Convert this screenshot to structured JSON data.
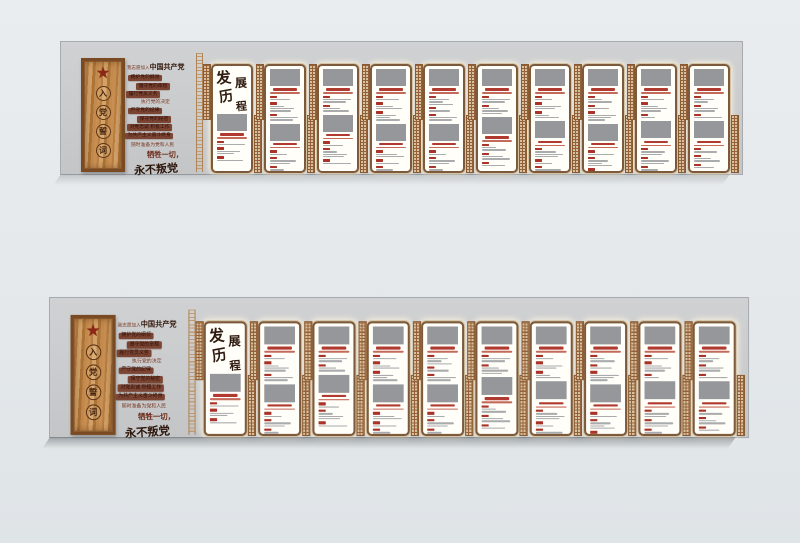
{
  "page": {
    "background": "#e6eaec",
    "banner_count": 2,
    "banner_instances": [
      "upper",
      "lower"
    ],
    "description_names": [
      "party-oath-plaque",
      "development-history-timeline-wall"
    ]
  },
  "colors": {
    "page_bg": "#e6eaec",
    "strip_gray": "#c9cbcd",
    "wood": "#c08a4e",
    "wood_frame": "#7a4a22",
    "star_red": "#8c2717",
    "oath_box": "#7c4433",
    "oath_text": "#7c3a24",
    "calligraphy_dark": "#2e1b10",
    "panel_border": "#7d5a3c",
    "accent_red": "#b13a30",
    "badge_red": "#a93328",
    "photo_gray": "#95979a",
    "lattice_tan": "#d7c2a0",
    "lattice_line": "#8a5a30"
  },
  "banner": {
    "plaque": {
      "star_icon": "red-star",
      "title_chars": [
        "入",
        "党",
        "誓",
        "词"
      ]
    },
    "oath": {
      "intro_prefix": "我志愿加入",
      "intro_party": "中国共产党",
      "lines": [
        {
          "text": "拥护党的纲领",
          "boxed": true,
          "indent": 3
        },
        {
          "text": "遵守党的章程",
          "boxed": true,
          "indent": 11
        },
        {
          "text": "履行党员义务",
          "boxed": true,
          "indent": 1
        },
        {
          "text": "执行党的决定",
          "boxed": false,
          "indent": 15
        },
        {
          "text": "严守党的纪律",
          "boxed": true,
          "indent": 3
        },
        {
          "text": "保守党的秘密",
          "boxed": true,
          "indent": 12
        },
        {
          "text": "对党忠诚  积极工作",
          "boxed": true,
          "indent": 2
        },
        {
          "text": "为共产主义奋斗终身",
          "boxed": true,
          "indent": 0
        }
      ],
      "ready": "随时准备为党和人民",
      "sacrifice": "牺牲一切，",
      "never": "永不叛党"
    },
    "intro_panel": {
      "title_chars": [
        "发",
        "展",
        "历",
        "程"
      ],
      "photo": "photo-placeholder",
      "entries": [
        1,
        2,
        1
      ]
    },
    "content_panels": [
      {
        "sections": [
          [
            1,
            3,
            2
          ],
          [
            1,
            2,
            2,
            1
          ]
        ]
      },
      {
        "sections": [
          [
            2,
            2
          ],
          [
            1,
            3,
            1
          ]
        ]
      },
      {
        "sections": [
          [
            1,
            2,
            3
          ],
          [
            2,
            1,
            2
          ]
        ]
      },
      {
        "sections": [
          [
            3,
            1,
            2
          ],
          [
            1,
            2,
            3
          ]
        ]
      },
      {
        "sections": [
          [
            2,
            3
          ],
          [
            2,
            2,
            1
          ]
        ]
      },
      {
        "sections": [
          [
            1,
            2,
            2
          ],
          [
            3,
            1,
            2
          ]
        ]
      },
      {
        "sections": [
          [
            2,
            1,
            3
          ],
          [
            1,
            3,
            2
          ]
        ]
      },
      {
        "sections": [
          [
            1,
            3,
            1
          ],
          [
            2,
            2,
            2
          ]
        ]
      },
      {
        "sections": [
          [
            2,
            2,
            1
          ],
          [
            1,
            2,
            1
          ]
        ]
      }
    ],
    "decor": {
      "lattice_divider": "lattice-pattern-strip",
      "scroll_border": "ornate-scroll-border"
    }
  }
}
